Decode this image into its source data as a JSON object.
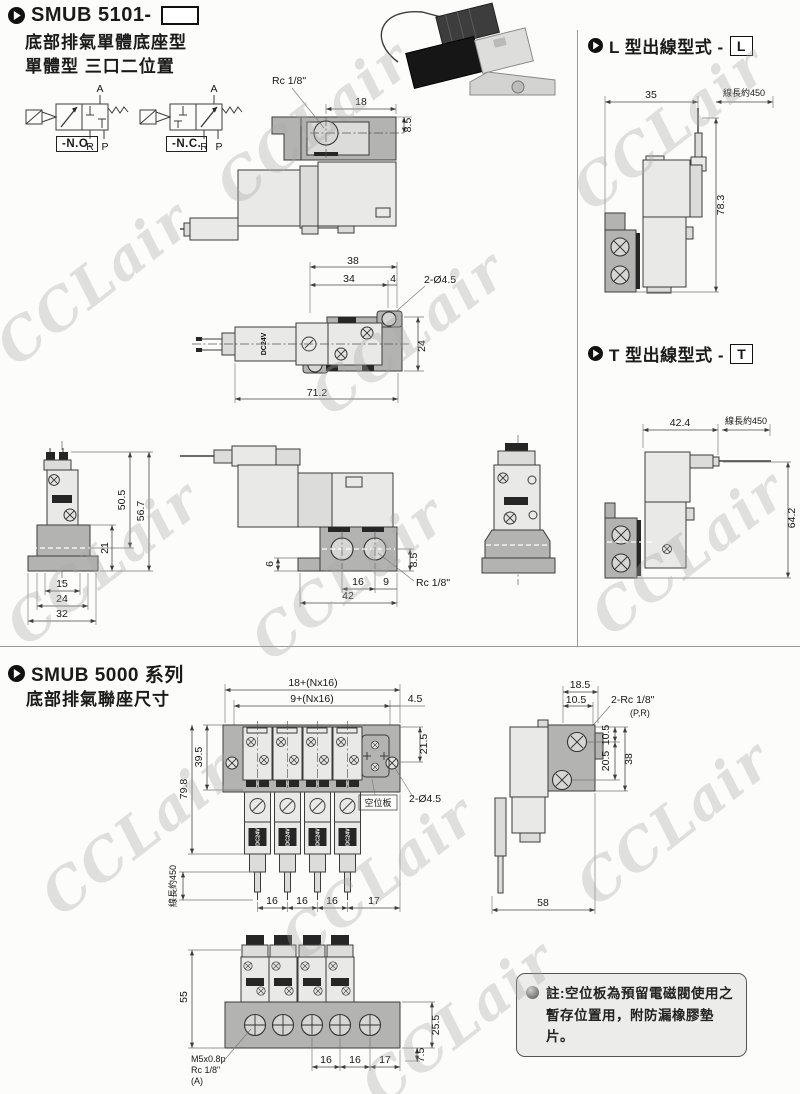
{
  "watermark": "CCLair",
  "header": {
    "model": "SMUB 5101-",
    "subtitle1": "底部排氣單體底座型",
    "subtitle2": "單體型 三口二位置"
  },
  "symbols": {
    "port_a": "A",
    "port_r": "R",
    "port_p": "P",
    "no_label": "-N.O.",
    "nc_label": "-N.C."
  },
  "top_view": {
    "rc": "Rc 1/8\"",
    "d18": "18",
    "d8_5": "8.5"
  },
  "plan_view": {
    "d38": "38",
    "d34": "34",
    "d4": "4",
    "holes": "2-Ø4.5",
    "d24": "24",
    "d71_2": "71.2",
    "coil": "DC24V"
  },
  "front_view": {
    "d50_5": "50.5",
    "d56_7": "56.7",
    "d21": "21",
    "d15": "15",
    "d24": "24",
    "d32": "32"
  },
  "side_view": {
    "d6": "6",
    "d8_5": "8.5",
    "d16": "16",
    "d9": "9",
    "rc": "Rc 1/8\"",
    "d42": "42"
  },
  "l_type": {
    "title": "L 型出線型式 -",
    "code": "L",
    "d35": "35",
    "wire": "線長約450",
    "d78_3": "78.3"
  },
  "t_type": {
    "title": "T 型出線型式 -",
    "code": "T",
    "d42_4": "42.4",
    "wire": "線長約450",
    "d64_2": "64.2"
  },
  "manifold": {
    "title1": "SMUB 5000 系列",
    "title2": "底部排氣聯座尺寸",
    "top": {
      "d_total": "18+(Nx16)",
      "d_pitch": "9+(Nx16)",
      "d4_5": "4.5",
      "d39_5": "39.5",
      "d79_8": "79.8",
      "d21_5": "21.5",
      "blank_label": "空位板",
      "holes": "2-Ø4.5",
      "wire": "線長約450",
      "d16a": "16",
      "d16b": "16",
      "d16c": "16",
      "d17": "17",
      "coil": "DC24V"
    },
    "side": {
      "d18_5": "18.5",
      "d10_5top": "10.5",
      "ports": "2-Rc 1/8\"",
      "ports_sub": "(P,R)",
      "d10_5": "10.5",
      "d20_5": "20.5",
      "d38": "38",
      "d58": "58"
    },
    "front": {
      "d55": "55",
      "thread1": "M5x0.8p",
      "thread2": "Rc 1/8\"",
      "thread3": "(A)",
      "d16a": "16",
      "d16b": "16",
      "d17": "17",
      "d25_5": "25.5",
      "d7_5": "7.5"
    }
  },
  "note": {
    "line1": "註:空位板為預留電磁閥使用之",
    "line2": "暫存位置用，附防漏橡膠墊片。"
  }
}
